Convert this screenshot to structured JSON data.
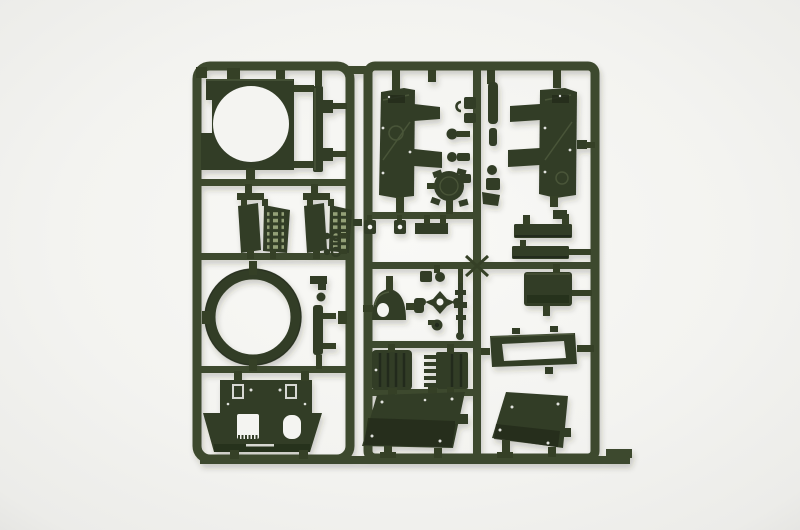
{
  "image": {
    "kind": "product-photograph",
    "description": "Photograph of a dark olive green injection-moulded plastic model kit sprue (parts tree) for a military tank model kit, lit on a plain white background. Two rectangular runner frames sit side by side, filled with moulded parts.",
    "alt": "Dark green plastic model kit sprue with tank parts on white background"
  },
  "colors": {
    "bg_center": "#f9f9f6",
    "bg_mid": "#f3f3f0",
    "bg_edge": "#e2e2df",
    "plastic_base": "#333d28",
    "plastic_dark": "#232b1a",
    "plastic_light": "#5f6e4a",
    "plastic_slot": "#93a077",
    "rail": "#3e4a2d",
    "rail_dark": "#344026",
    "cutout": "#f4f4f1"
  },
  "sprue": {
    "material": "dark olive green styrene",
    "left_frame": "tall rectangular runner frame with rounded corners",
    "right_frame": "wide rectangular runner frame with internal cross runners",
    "parts": {
      "turret_roof_plate": "Square turret roof plate with large circular turret-ring opening",
      "long_plank": "Long narrow plank part with two side lugs",
      "engine_grille_left": "Engine intake grille pair with slotted vents (left)",
      "engine_grille_right": "Engine intake grille pair with slotted vents (right)",
      "turret_ring": "Large open turret ring (annulus)",
      "upper_hull_plate": "Upper hull roof plate with square and rounded hatch openings and flared sides",
      "fender_panel_left": "Left hull side / fender panel with two mud-flap wings",
      "fender_panel_right": "Right hull side / fender panel with two mud-flap wings",
      "fittings_cluster": "Cluster of small fittings: clamps, lift hooks, periscopes and knobs around centre runner",
      "round_hatch": "Round crew hatch with four hinge tabs",
      "commander_cupola": "Dome shaped commander cupola with vision port hole",
      "hub_cross": "Four pointed wheel-hub cross with centre hole",
      "machine_gun_rod": "Thin machine-gun / barrel rod part",
      "ribbed_box_left": "Ribbed transmission box",
      "ribbed_box_right": "Box part with comb-like cooling teeth",
      "glacis_plate": "Angled glacis hull plate with rivets",
      "rear_hull_plate": "Angled rear hull plate with rivets",
      "engine_deck_frame": "Open rectangular engine-deck frame",
      "stowage_plank_1": "Narrow stowage plank",
      "stowage_plank_2": "Narrow stowage plank",
      "stowage_box": "Rectangular stowage box",
      "side_clips": "Small clip and ball fittings on runner",
      "mount_plank": "Small vertical mounting plank with ball fitting"
    }
  }
}
